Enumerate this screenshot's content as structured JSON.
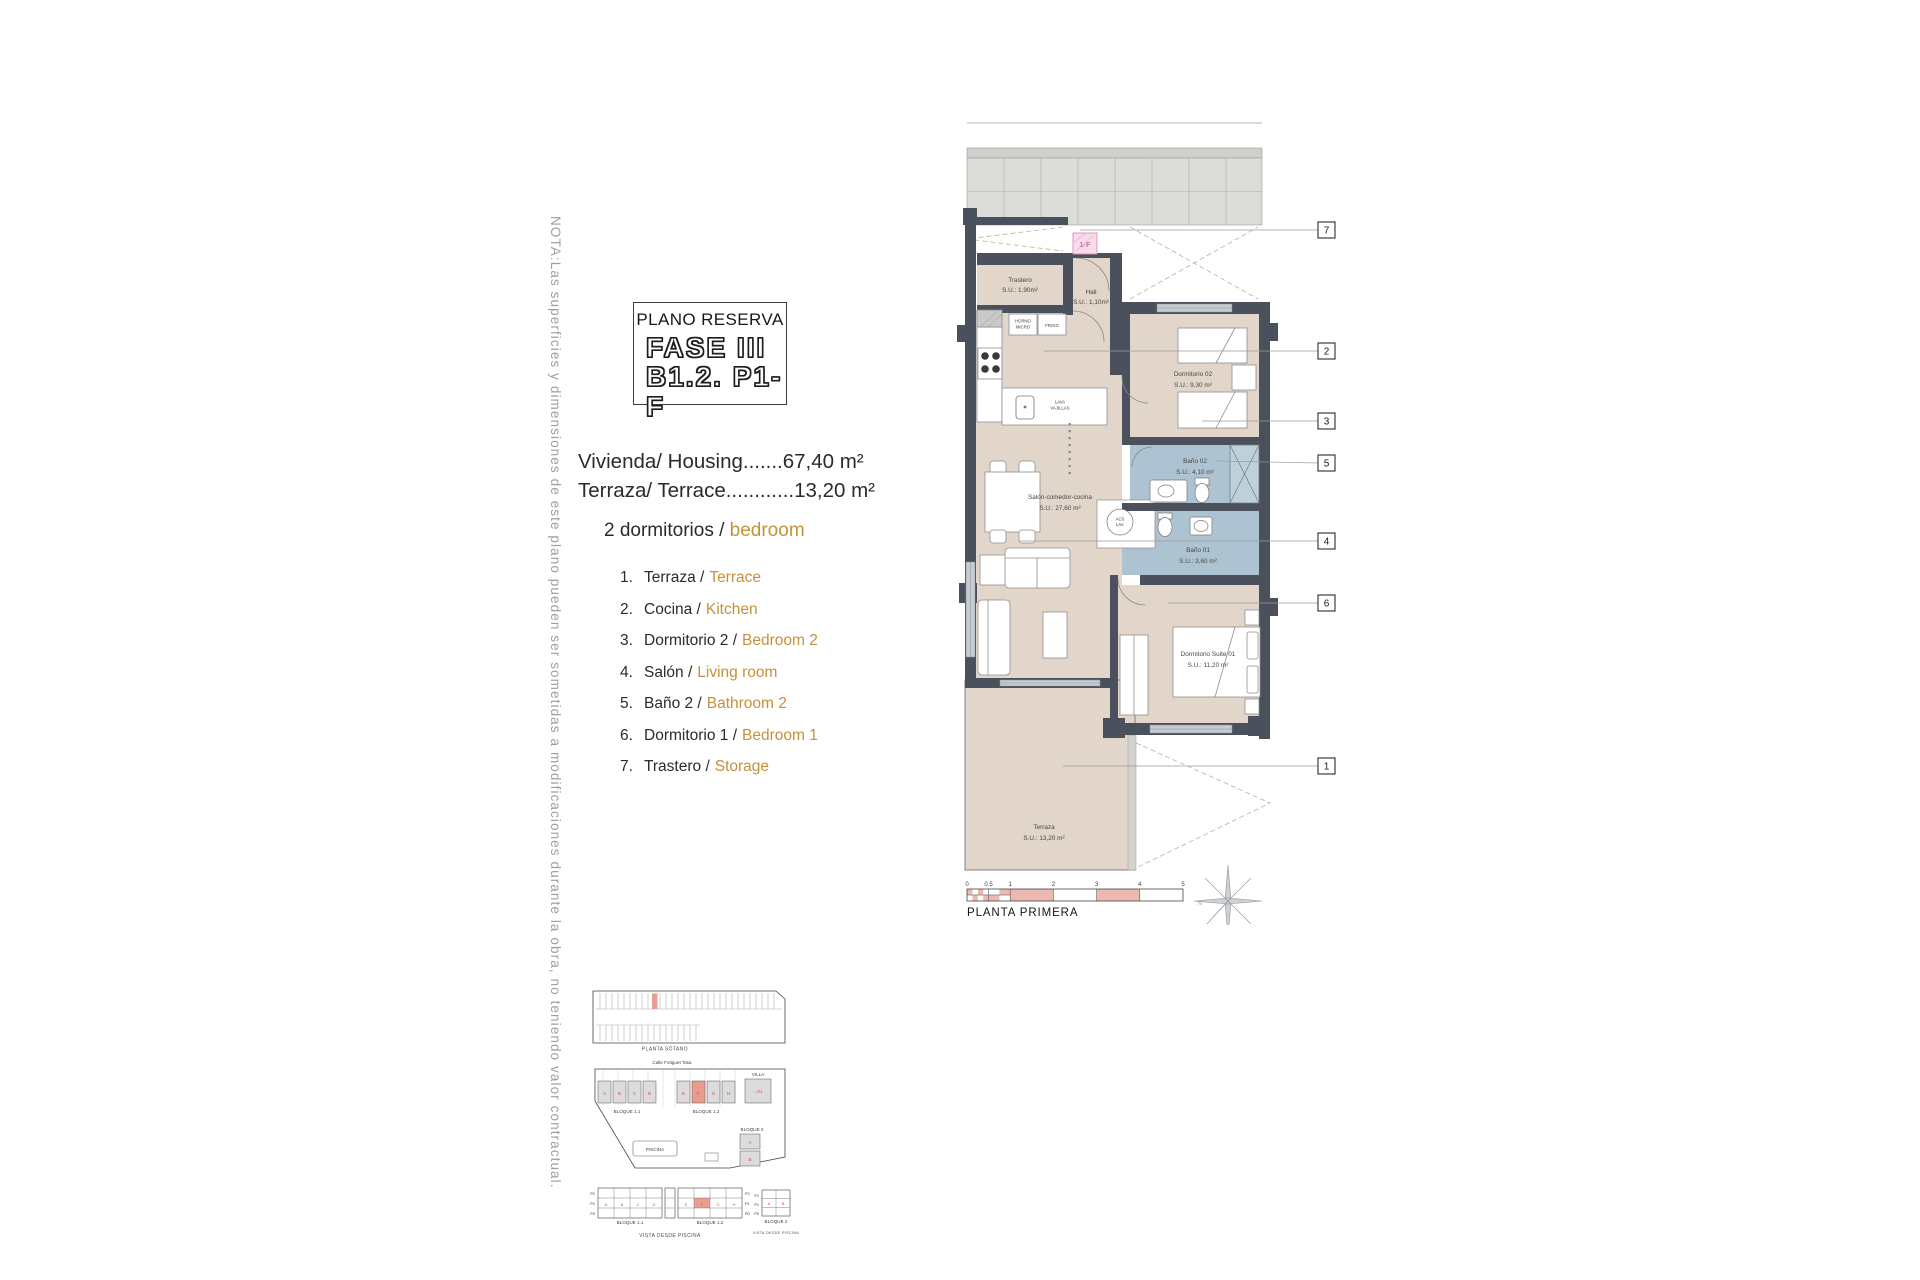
{
  "note_vertical": "NOTA:Las superficies y dimensiones de este plano pueden ser sometidas a modificaciones durante la obra, no teniendo valor contractual.",
  "title_block": {
    "line1": "PLANO RESERVA",
    "line2": "FASE III",
    "line3": "B1.2. P1-F"
  },
  "measurements": {
    "housing": "Vivienda/ Housing.......67,40 m²",
    "terrace": "Terraza/ Terrace............13,20 m²"
  },
  "bedrooms": {
    "es": "2 dormitorios /",
    "en": "bedroom"
  },
  "legend": [
    {
      "num": "1.",
      "es": "Terraza /",
      "en": "Terrace"
    },
    {
      "num": "2.",
      "es": "Cocina /",
      "en": "Kitchen"
    },
    {
      "num": "3.",
      "es": "Dormitorio 2 /",
      "en": "Bedroom 2"
    },
    {
      "num": "4.",
      "es": "Salón /",
      "en": "Living room"
    },
    {
      "num": "5.",
      "es": "Baño 2 /",
      "en": "Bathroom 2"
    },
    {
      "num": "6.",
      "es": "Dormitorio 1 /",
      "en": "Bedroom 1"
    },
    {
      "num": "7.",
      "es": "Trastero /",
      "en": "Storage"
    }
  ],
  "plan": {
    "unit_tag": "1-F",
    "rooms": [
      {
        "name": "Trastero",
        "area": "S.U.: 1,90m²"
      },
      {
        "name": "Hall",
        "area": "S.U.: 1,10m²"
      },
      {
        "name": "Dormitorio 02",
        "area": "S.U.: 9,30 m²"
      },
      {
        "name": "Baño 02",
        "area": "S.U.: 4,10 m²"
      },
      {
        "name": "Salón-comedor-cocina",
        "area": "S.U.: 27,60 m²"
      },
      {
        "name": "Baño 01",
        "area": "S.U.: 3,60 m²"
      },
      {
        "name": "Dormitorio Suite 01",
        "area": "S.U.: 11,20 m²"
      },
      {
        "name": "Terraza",
        "area": "S.U.: 13,20 m²"
      }
    ],
    "appliances": {
      "horno1": "HORNO",
      "horno2": "MICRO",
      "frigo": "FRIGO",
      "lava1": "LAVA",
      "lava2": "VAJILLAS",
      "acs1": "ACS",
      "acs2": "LAV."
    },
    "callouts": [
      "7",
      "2",
      "3",
      "5",
      "4",
      "6",
      "1"
    ],
    "scale_ticks": [
      "0",
      "0.5",
      "1",
      "2",
      "3",
      "4",
      "5"
    ],
    "compass_n": "N",
    "caption": "PLANTA PRIMERA"
  },
  "site": {
    "sotano_caption": "PLANTA SÓTANO",
    "street": "Calle Fotiguet Tasa",
    "bloque11": {
      "label": "BLOQUE 1.1",
      "units": [
        "A",
        "B",
        "C",
        "D"
      ]
    },
    "bloque12": {
      "label": "BLOQUE 1.2",
      "units": [
        "E",
        "F",
        "G",
        "H"
      ]
    },
    "villa": {
      "label": "VILLA",
      "unit": "...01"
    },
    "bloque2": {
      "label": "BLOQUE 2",
      "units": [
        "A",
        "B"
      ]
    },
    "piscina": "PISCINA"
  },
  "elevations": {
    "rows": [
      "P2",
      "P1",
      "P0"
    ],
    "bloque11_label": "BLOQUE 1.1",
    "bloque12_label": "BLOQUE 1.2",
    "bloque2_label": "BLOQUE 2",
    "caption": "VISTA DESDE PISCINA"
  },
  "colors": {
    "accent_orange": "#c4913c",
    "wall": "#4a505c",
    "floor_beige": "#e2d5c9",
    "bath_blue": "#aec3d1",
    "shower_blue": "#bdd0dc",
    "window_gray": "#c6cbd0",
    "highlight_red": "#e89d90",
    "scale_salmon": "#ecb9b0",
    "pink_tag": "#df8fb5",
    "note_gray": "#9aa0a7"
  }
}
